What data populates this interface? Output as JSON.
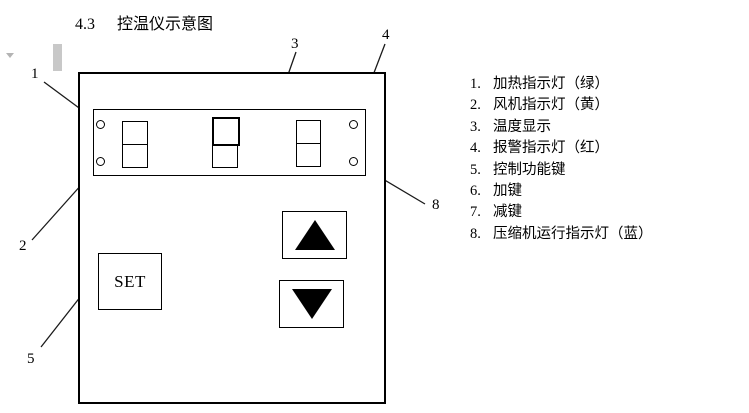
{
  "title": {
    "section": "4.3",
    "text": "控温仪示意图"
  },
  "figure": {
    "set_button_label": "SET",
    "callout_labels": [
      "1",
      "2",
      "3",
      "4",
      "5",
      "6",
      "7",
      "8"
    ]
  },
  "legend": {
    "items": [
      {
        "num": "1.",
        "text": "加热指示灯（绿）"
      },
      {
        "num": "2.",
        "text": "风机指示灯（黄）"
      },
      {
        "num": "3.",
        "text": "温度显示"
      },
      {
        "num": "4.",
        "text": "报警指示灯（红）"
      },
      {
        "num": "5.",
        "text": "控制功能键"
      },
      {
        "num": "6.",
        "text": "加键"
      },
      {
        "num": "7.",
        "text": "减键"
      },
      {
        "num": "8.",
        "text": "压缩机运行指示灯（蓝）"
      }
    ]
  },
  "colors": {
    "line": "#000000",
    "scroll_marker": "#c8c8c8"
  }
}
